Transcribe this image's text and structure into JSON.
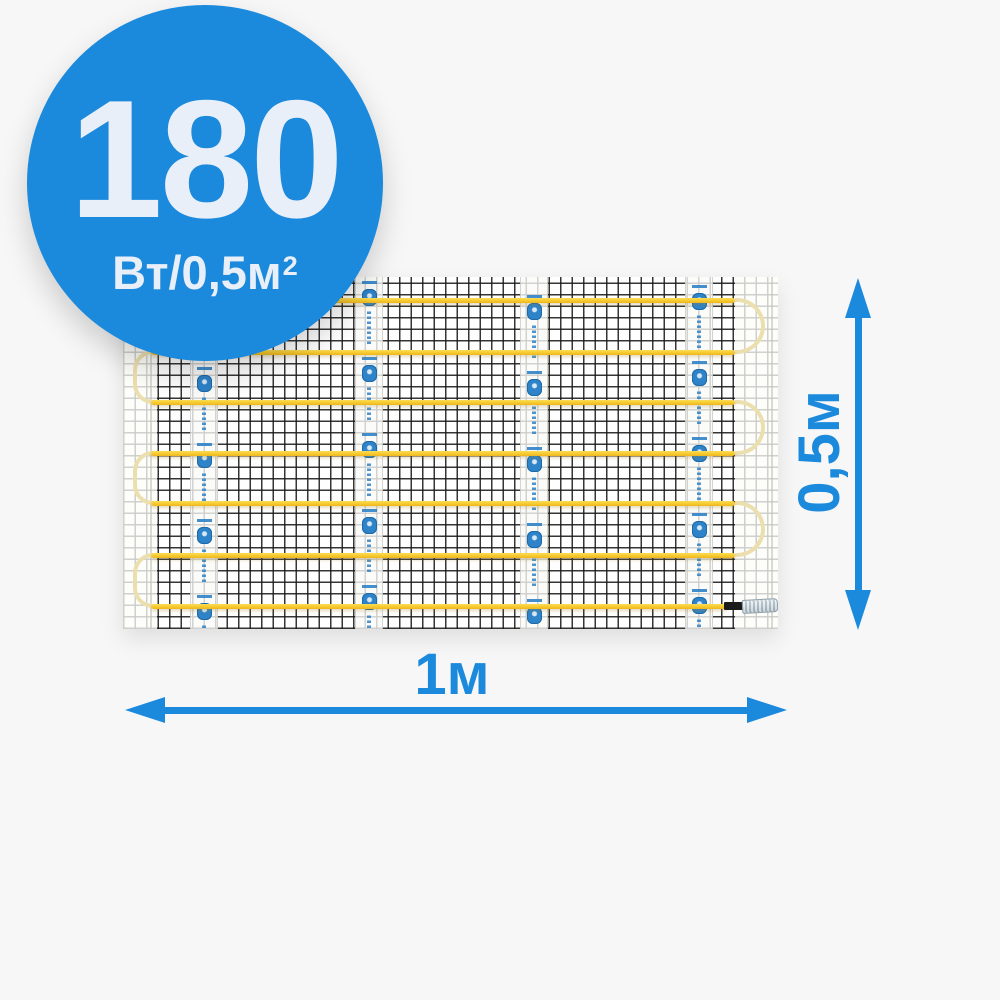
{
  "badge": {
    "value": "180",
    "unit_main": "Вт/0,5м",
    "unit_sup": "2"
  },
  "dimensions": {
    "width_label": "1м",
    "height_label": "0,5м"
  },
  "product": {
    "type": "electric-heating-mat",
    "cable_rows": 7,
    "row_centers_px": [
      23,
      75,
      125,
      176,
      226,
      278,
      329
    ],
    "row_left_px": 28,
    "row_width_px": 584,
    "last_row_width_px": 577,
    "right_loop_pairs": [
      [
        0,
        1
      ],
      [
        2,
        3
      ],
      [
        4,
        5
      ]
    ],
    "left_loop_pairs": [
      [
        1,
        2
      ],
      [
        3,
        4
      ],
      [
        5,
        6
      ]
    ],
    "tape_strip_lefts_px": [
      67,
      232,
      397,
      562
    ],
    "tape_stamp_offsets_px": [
      14,
      4,
      18,
      8
    ],
    "tape_stamp_period_px": 76,
    "tape_stamps_per_strip": 5,
    "seam_lefts_px": [
      27,
      648
    ],
    "connector": {
      "sleeve_left_px": 601,
      "sleeve_width_px": 20,
      "tip_left_px": 619,
      "tip_width_px": 34
    }
  },
  "colors": {
    "background": "#f7f7f7",
    "accent": "#1b89dc",
    "badge_text": "#e9eff8",
    "cable": "#f7ca2e",
    "cable_pale": "#ecdfae",
    "mesh": "rgba(25,25,25,0.88)",
    "stamp_blue": "#2f83c9",
    "connector_sleeve": "#1b1b1b",
    "connector_tip": "#a9b8c2"
  }
}
